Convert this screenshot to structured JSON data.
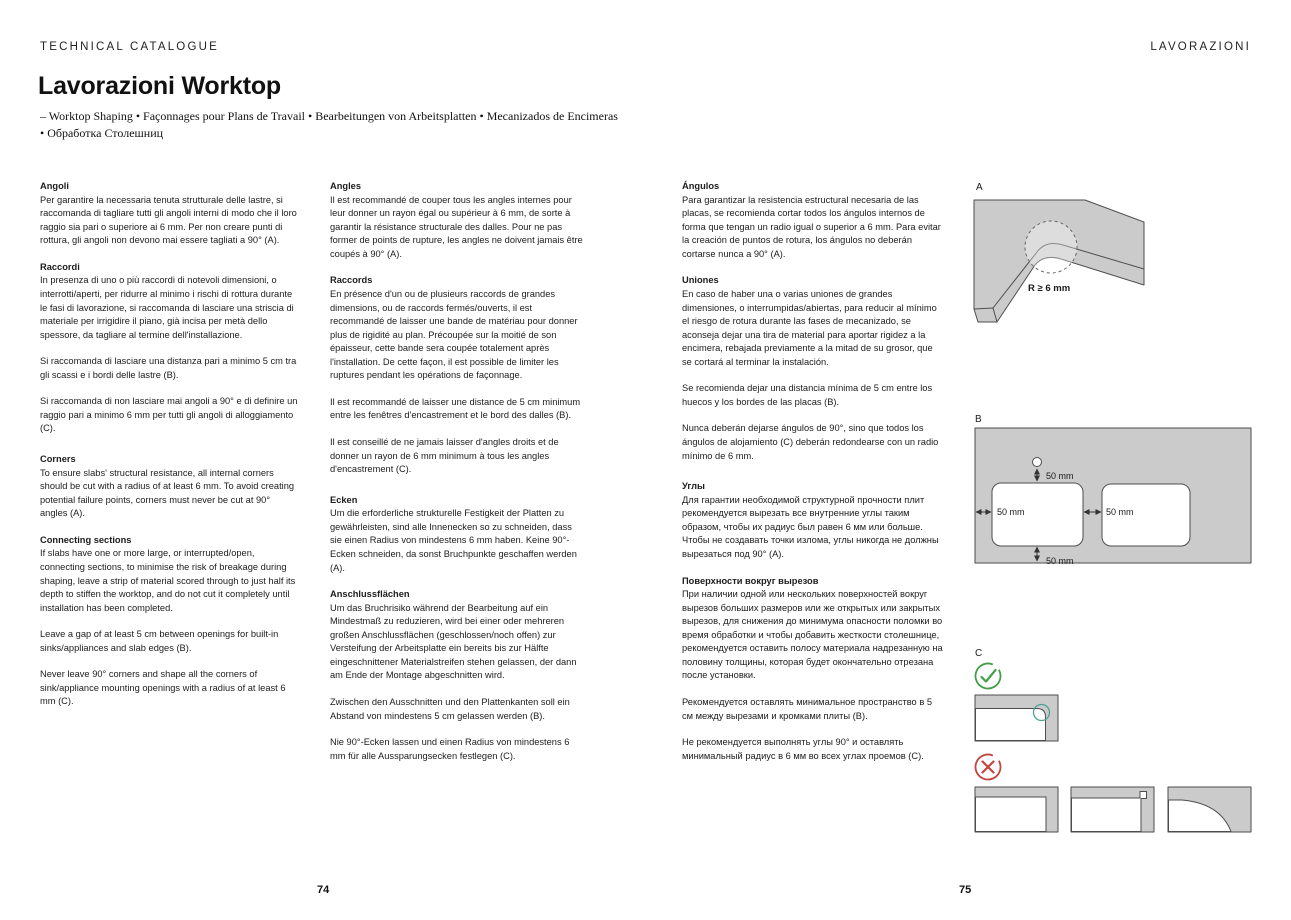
{
  "page": {
    "header_left": "TECHNICAL CATALOGUE",
    "header_right": "LAVORAZIONI",
    "title": "Lavorazioni Worktop",
    "subtitle_lines": [
      "– Worktop Shaping • Façonnages pour Plans de Travail • Bearbeitungen von Arbeitsplatten • Mecanizados de Encimeras",
      "• Обработка Столешниц"
    ],
    "page_number_left": "74",
    "page_number_right": "75"
  },
  "columns": [
    {
      "blocks": [
        {
          "heading": "Angoli",
          "paragraphs": [
            "Per garantire la necessaria tenuta strutturale delle lastre, si raccomanda di tagliare tutti gli angoli interni di modo che il loro raggio sia pari o superiore ai 6 mm. Per non creare punti di rottura, gli angoli non devono mai essere tagliati a 90° (A)."
          ]
        },
        {
          "heading": "Raccordi",
          "paragraphs": [
            "In presenza di uno o più raccordi di notevoli dimensioni, o interrotti/aperti, per ridurre al minimo i rischi di rottura durante le fasi di lavorazione, si raccomanda di lasciare una striscia di materiale per irrigidire il piano, già incisa per metà dello spessore, da tagliare al termine dell'installazione.",
            "Si raccomanda di lasciare una distanza pari a minimo 5 cm tra gli scassi e i bordi delle lastre (B).",
            "Si raccomanda di non lasciare mai angoli a 90° e di definire un raggio pari a minimo 6 mm per tutti gli angoli di alloggiamento (C)."
          ]
        },
        {
          "gap": true,
          "heading": "Corners",
          "paragraphs": [
            "To ensure slabs' structural resistance, all internal corners should be cut with a radius of at least 6 mm. To avoid creating potential failure points, corners must never be cut at 90° angles (A)."
          ]
        },
        {
          "heading": "Connecting sections",
          "paragraphs": [
            "If slabs have one or more large, or interrupted/open, connecting sections, to minimise the risk of breakage during shaping, leave a strip of material scored through to just half its depth to stiffen the worktop, and do not cut it completely until installation has been completed.",
            "Leave a gap of at least 5 cm between openings for built-in sinks/appliances and slab edges (B).",
            "Never leave 90° corners and shape all the corners of sink/appliance mounting openings with a radius of at least 6 mm (C)."
          ]
        }
      ]
    },
    {
      "blocks": [
        {
          "heading": "Angles",
          "paragraphs": [
            "Il est recommandé de couper tous les angles internes pour leur donner un rayon égal ou supérieur à 6 mm, de sorte à garantir la résistance structurale des dalles. Pour ne pas former de points de rupture, les angles ne doivent jamais être coupés à 90° (A)."
          ]
        },
        {
          "heading": "Raccords",
          "paragraphs": [
            "En présence d'un ou de plusieurs raccords de grandes dimensions, ou de raccords fermés/ouverts, il est recommandé de laisser une bande de matériau pour donner plus de rigidité au plan. Précoupée sur la moitié de son épaisseur, cette bande sera coupée totalement après l'installation. De cette façon, il est possible de limiter les ruptures pendant les opérations de façonnage.",
            "Il est recommandé de laisser une distance de 5 cm minimum entre les fenêtres d'encastrement et le bord des dalles (B).",
            "Il est conseillé de ne jamais laisser d'angles droits et de donner un rayon de 6 mm minimum à tous les angles d'encastrement (C)."
          ]
        },
        {
          "gap": true,
          "heading": "Ecken",
          "paragraphs": [
            "Um die erforderliche strukturelle Festigkeit der Platten zu gewährleisten, sind alle Innenecken so zu schneiden, dass sie einen Radius von mindestens 6 mm haben. Keine 90°-Ecken schneiden, da sonst Bruchpunkte geschaffen werden (A)."
          ]
        },
        {
          "heading": "Anschlussflächen",
          "paragraphs": [
            "Um das Bruchrisiko während der Bearbeitung auf ein Mindestmaß zu reduzieren, wird bei einer oder mehreren großen Anschlussflächen (geschlossen/noch offen) zur Versteifung der Arbeitsplatte ein bereits bis zur Hälfte eingeschnittener Materialstreifen stehen gelassen, der dann am Ende der Montage abgeschnitten wird.",
            "Zwischen den Ausschnitten und den Plattenkanten soll ein Abstand von mindestens 5 cm gelassen werden (B).",
            "Nie 90°-Ecken lassen und einen Radius von mindestens 6 mm für alle Aussparungsecken festlegen (C)."
          ]
        }
      ]
    },
    {
      "blocks": [
        {
          "heading": "Ángulos",
          "paragraphs": [
            "Para garantizar la resistencia estructural necesaria de las placas, se recomienda cortar todos los ángulos internos de forma que tengan un radio igual o superior a 6 mm. Para evitar la creación de puntos de rotura, los ángulos no deberán cortarse nunca a 90° (A)."
          ]
        },
        {
          "heading": "Uniones",
          "paragraphs": [
            "En caso de haber una o varias uniones de grandes dimensiones, o interrumpidas/abiertas, para reducir al mínimo el riesgo de rotura durante las fases de mecanizado, se aconseja dejar una tira de material para aportar rigidez a la encimera, rebajada previamente a la mitad de su grosor, que se cortará al terminar la instalación.",
            "Se recomienda dejar una distancia mínima de 5 cm entre los huecos y los bordes de las placas (B).",
            "Nunca deberán dejarse ángulos de 90°, sino que todos los ángulos de alojamiento (C) deberán redondearse con un radio mínimo de 6 mm."
          ]
        },
        {
          "gap": true,
          "heading": "Углы",
          "paragraphs": [
            "Для гарантии необходимой структурной прочности плит рекомендуется вырезать все внутренние углы таким образом, чтобы их радиус был равен 6 мм или больше. Чтобы не создавать точки излома, углы никогда не должны вырезаться под 90° (A)."
          ]
        },
        {
          "heading": "Поверхности вокруг вырезов",
          "paragraphs": [
            "При наличии одной или нескольких поверхностей вокруг вырезов больших размеров или же открытых или закрытых вырезов, для снижения до минимума опасности поломки во время обработки и чтобы добавить жесткости столешнице, рекомендуется оставить полосу материала надрезанную на половину толщины, которая будет окончательно отрезана после установки.",
            "Рекомендуется оставлять минимальное пространство в 5 см между вырезами и кромками плиты (B).",
            "Не рекомендуется выполнять углы 90° и оставлять минимальный радиус в 6 мм во всех углах проемов (C)."
          ]
        }
      ]
    }
  ],
  "diagrams": {
    "a": {
      "label": "A",
      "radius_label": "R ≥ 6 mm"
    },
    "b": {
      "label": "B",
      "dims": [
        "50 mm",
        "50 mm",
        "50 mm",
        "50 mm"
      ]
    },
    "c": {
      "label": "C"
    }
  },
  "icons": {
    "approved": "check-circle-stamp",
    "rejected": "cross-circle-stamp"
  },
  "colors": {
    "slab_fill": "#cbcbcb",
    "line": "#4d4d4d",
    "check_green": "#43a047",
    "cross_red": "#c2453f",
    "highlight_teal": "#4aa392",
    "text": "#1a1a1a"
  }
}
